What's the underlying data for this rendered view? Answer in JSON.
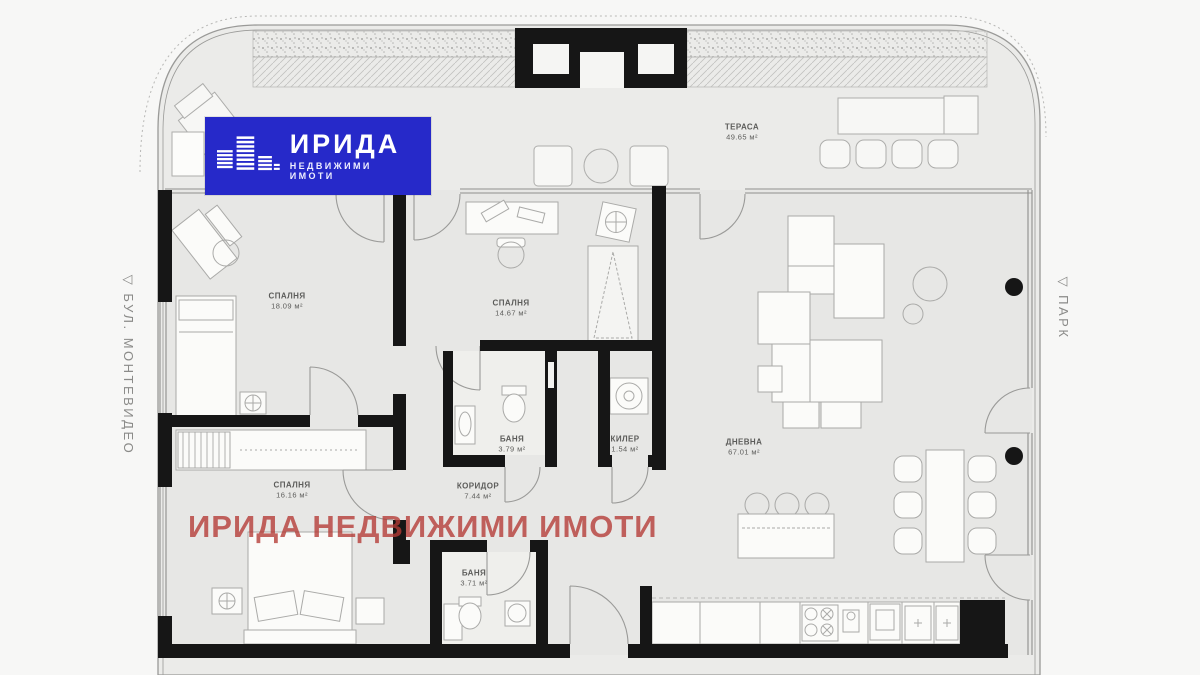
{
  "branding": {
    "logo_title": "ИРИДА",
    "logo_subtitle": "НЕДВИЖИМИ ИМОТИ",
    "watermark": "ИРИДА НЕДВИЖИМИ ИМОТИ"
  },
  "context_labels": {
    "left_street": "▽ БУЛ. МОНТЕВИДЕО",
    "right_area": "▽ ПАРК"
  },
  "rooms": [
    {
      "name": "ТЕРАСА",
      "area": "49.65 м²"
    },
    {
      "name": "СПАЛНЯ",
      "area": "18.09 м²"
    },
    {
      "name": "СПАЛНЯ",
      "area": "14.67 м²"
    },
    {
      "name": "СПАЛНЯ",
      "area": "16.16 м²"
    },
    {
      "name": "БАНЯ",
      "area": "3.79 м²"
    },
    {
      "name": "КИЛЕР",
      "area": "1.54 м²"
    },
    {
      "name": "КОРИДОР",
      "area": "7.44 м²"
    },
    {
      "name": "ДНЕВНА",
      "area": "67.01 м²"
    },
    {
      "name": "БАНЯ",
      "area": "3.71 м²"
    }
  ],
  "colors": {
    "logo-blue": "#2629c9",
    "watermark-red": "#b43a35",
    "wall-black": "#161616",
    "floor-gray": "#e7e7e5",
    "terrace-gray": "#ebebe9",
    "line-gray": "#9a9a98"
  }
}
